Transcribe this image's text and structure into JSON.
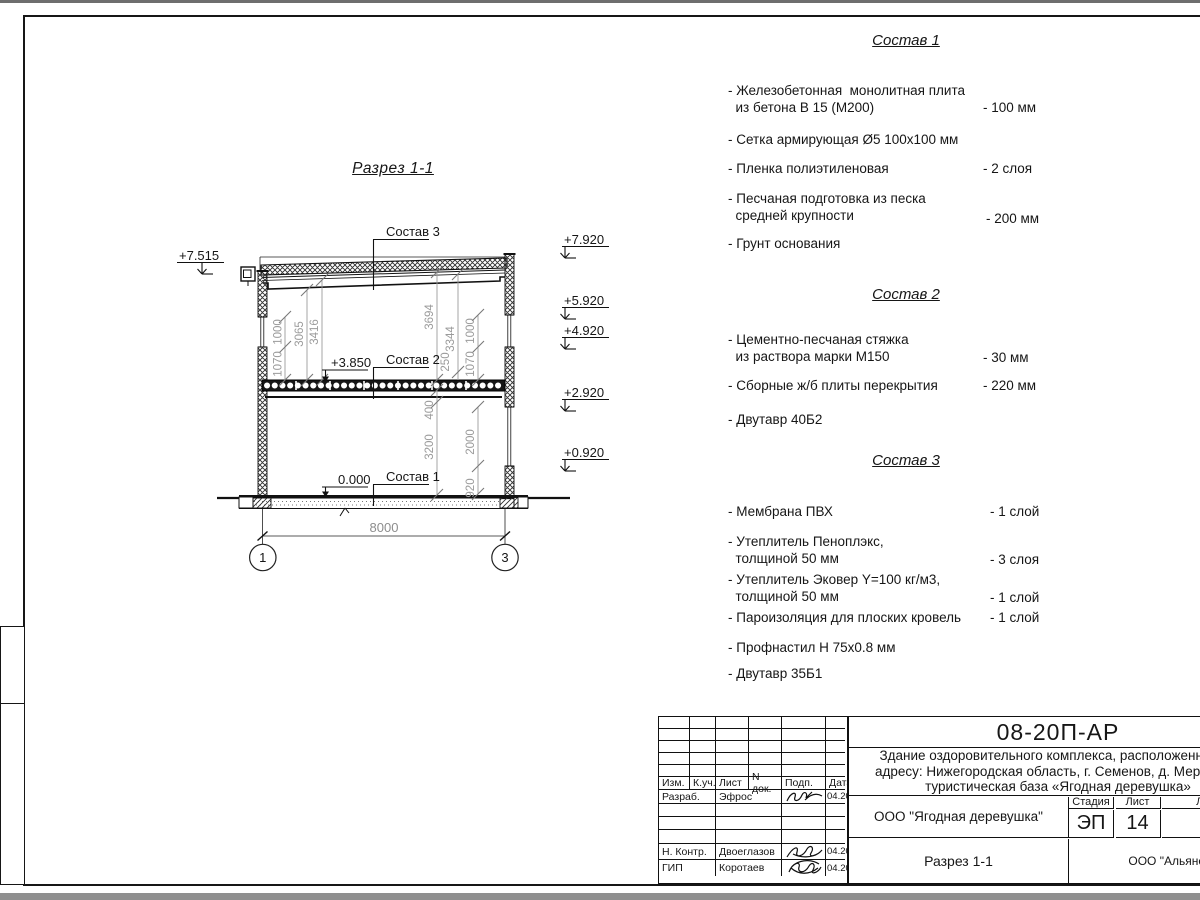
{
  "drawing": {
    "title": "Разрез 1-1",
    "labels": {
      "comp1": "Состав 1",
      "comp2": "Состав 2",
      "comp3": "Состав 3"
    },
    "elevations": {
      "eave": "+7.515",
      "floor2": "+3.850",
      "floor0": "0.000",
      "right": [
        "+7.920",
        "+5.920",
        "+4.920",
        "+2.920",
        "+0.920"
      ]
    },
    "dimensions": {
      "left": [
        "1000",
        "1070",
        "3065",
        "3416"
      ],
      "right_upper": [
        "3694",
        "3344",
        "250",
        "1000",
        "1070"
      ],
      "right_lower": [
        "400",
        "3200",
        "2000",
        "920"
      ],
      "span": "8000"
    },
    "axes": [
      "1",
      "3"
    ]
  },
  "compositions": [
    {
      "title": "Состав 1",
      "items": [
        {
          "text": "- Железобетонная  монолитная плита\n  из бетона В 15 (М200)",
          "value": "- 100 мм"
        },
        {
          "text": "- Сетка армирующая Ø5 100х100 мм",
          "value": ""
        },
        {
          "text": "- Пленка полиэтиленовая",
          "value": "-  2 слоя"
        },
        {
          "text": "- Песчаная подготовка из песка\n  средней крупности",
          "value": "- 200 мм"
        },
        {
          "text": "- Грунт основания",
          "value": ""
        }
      ]
    },
    {
      "title": "Состав 2",
      "items": [
        {
          "text": "- Цементно-песчаная стяжка\n  из раствора марки М150",
          "value": "- 30 мм"
        },
        {
          "text": "- Сборные ж/б плиты перекрытия",
          "value": "- 220 мм"
        },
        {
          "text": "- Двутавр 40Б2",
          "value": ""
        }
      ]
    },
    {
      "title": "Состав 3",
      "items": [
        {
          "text": "- Мембрана ПВХ",
          "value": "- 1 слой"
        },
        {
          "text": "- Утеплитель Пеноплэкс,\n  толщиной 50 мм",
          "value": "- 3 слоя"
        },
        {
          "text": "- Утеплитель Эковер Y=100 кг/м3,\n  толщиной 50 мм",
          "value": "- 1 слой"
        },
        {
          "text": "- Пароизоляция для плоских кровель",
          "value": "- 1 слой"
        },
        {
          "text": "- Профнастил Н 75х0.8 мм",
          "value": ""
        },
        {
          "text": "- Двутавр 35Б1",
          "value": ""
        }
      ]
    }
  ],
  "title_block": {
    "doc_code": "08-20П-АР",
    "project": "Здание оздоровительного комплекса, расположенное по\nадресу: Нижегородская область, г. Семенов, д. Мериново,\nтуристическая база «Ягодная деревушка»",
    "org_customer": "ООО \"Ягодная деревушка\"",
    "section_name": "Разрез 1-1",
    "org_designer": "ООО \"Альянс\"",
    "stage_label": "Стадия",
    "sheet_label": "Лист",
    "sheets_label": "Листов",
    "stage": "ЭП",
    "sheet_no": "14",
    "header_cols": [
      "Изм.",
      "К.уч.",
      "Лист",
      "N док.",
      "Подп.",
      "Дата"
    ],
    "rows": [
      {
        "role": "Разраб.",
        "name": "Эфрос",
        "date": "04.20"
      },
      {
        "role": "Н. Контр.",
        "name": "Двоеглазов",
        "date": "04.20"
      },
      {
        "role": "ГИП",
        "name": "Коротаев",
        "date": "04.20"
      }
    ]
  }
}
